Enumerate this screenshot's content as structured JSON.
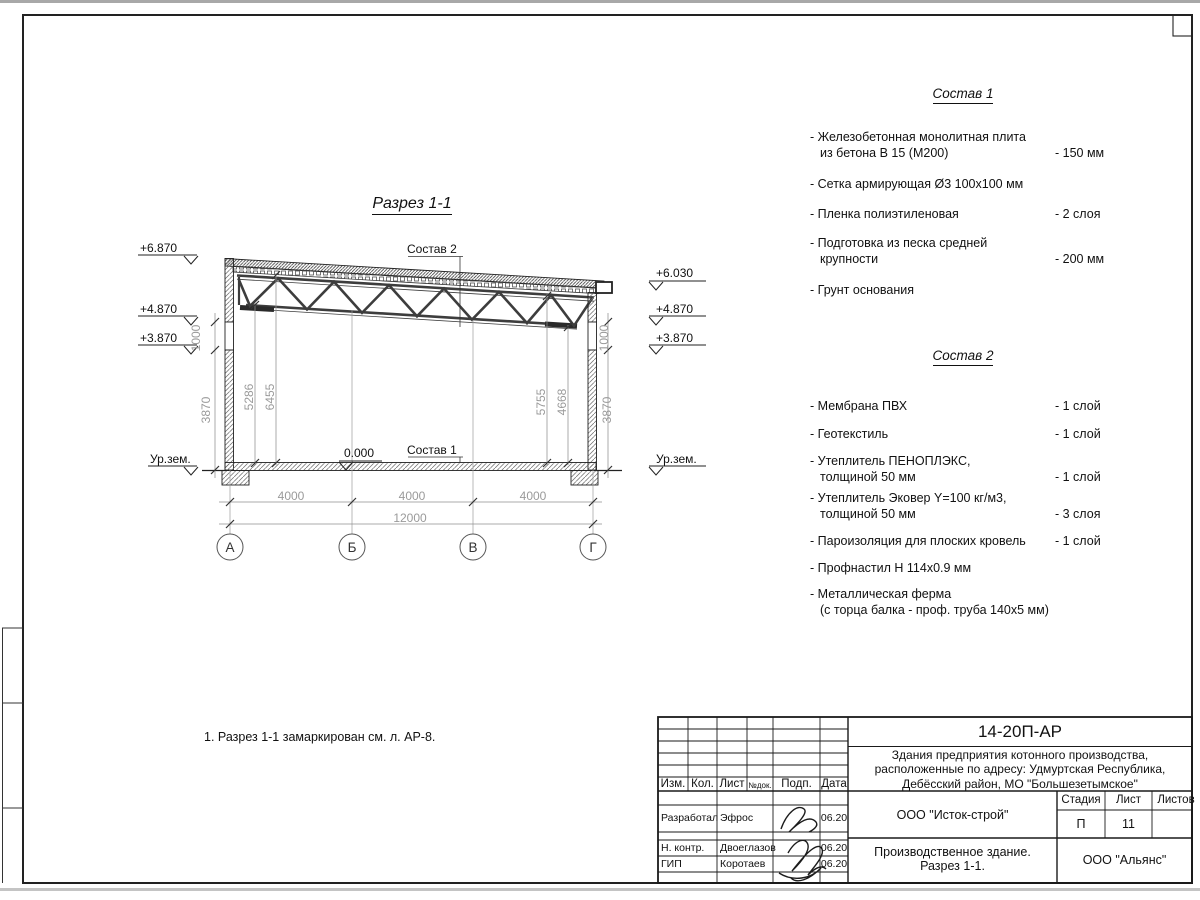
{
  "drawing": {
    "title": "Разрез 1-1",
    "note": "1. Разрез 1-1 замаркирован см. л. АР-8.",
    "labels": {
      "sostav1_ref": "Состав 1",
      "sostav2_ref": "Состав 2",
      "zero": "0.000",
      "ground_left": "Ур.зем.",
      "ground_right": "Ур.зем."
    },
    "elevations_left": [
      "+6.870",
      "+4.870",
      "+3.870"
    ],
    "elevations_right": [
      "+6.030",
      "+4.870",
      "+3.870"
    ],
    "axes": [
      "А",
      "Б",
      "В",
      "Г"
    ],
    "dims": {
      "spans": [
        "4000",
        "4000",
        "4000"
      ],
      "total": "12000",
      "wall_left": [
        "1000",
        "3870"
      ],
      "wall_right": [
        "1000",
        "3870"
      ],
      "interior_left": [
        "5286",
        "6455"
      ],
      "interior_right": [
        "5755",
        "4668"
      ]
    }
  },
  "sostav1": {
    "title": "Состав 1",
    "items": [
      {
        "l1": "- Железобетонная  монолитная плита",
        "l2": "из бетона В 15 (М200)",
        "val": "- 150 мм"
      },
      {
        "l1": "- Сетка армирующая Ø3 100х100 мм",
        "l2": "",
        "val": ""
      },
      {
        "l1": "- Пленка полиэтиленовая",
        "l2": "",
        "val": "-  2 слоя"
      },
      {
        "l1": "- Подготовка из песка средней",
        "l2": "крупности",
        "val": "- 200 мм"
      },
      {
        "l1": "- Грунт основания",
        "l2": "",
        "val": ""
      }
    ]
  },
  "sostav2": {
    "title": "Состав 2",
    "items": [
      {
        "l1": "- Мембрана ПВХ",
        "l2": "",
        "val": "- 1 слой"
      },
      {
        "l1": "- Геотекстиль",
        "l2": "",
        "val": "- 1 слой"
      },
      {
        "l1": "- Утеплитель ПЕНОПЛЭКС,",
        "l2": "толщиной 50 мм",
        "val": "- 1 слой"
      },
      {
        "l1": "- Утеплитель Эковер Y=100 кг/м3,",
        "l2": "толщиной 50 мм",
        "val": "- 3 слоя"
      },
      {
        "l1": "- Пароизоляция для плоских кровель",
        "l2": "",
        "val": "- 1 слой"
      },
      {
        "l1": "- Профнастил Н 114х0.9 мм",
        "l2": "",
        "val": ""
      },
      {
        "l1": "- Металлическая ферма",
        "l2": "(с торца балка - проф. труба 140х5 мм)",
        "val": ""
      }
    ]
  },
  "titleblock": {
    "doc_number": "14-20П-АР",
    "project_name_l1": "Здания предприятия котонного производства,",
    "project_name_l2": "расположенные по адресу: Удмуртская Республика,",
    "project_name_l3": "Дебёсский район, МО \"Большезетымское\"",
    "org1": "ООО \"Исток-строй\"",
    "org2": "ООО \"Альянс\"",
    "sheet_title_l1": "Производственное здание.",
    "sheet_title_l2": "Разрез 1-1.",
    "cols": {
      "izm": "Изм.",
      "kol": "Кол.",
      "list": "Лист",
      "ndok": "№док.",
      "podp": "Подп.",
      "data": "Дата"
    },
    "stage_header": {
      "stadia": "Стадия",
      "list": "Лист",
      "listov": "Листов"
    },
    "stage": "П",
    "sheet_no": "11",
    "rows": [
      {
        "role": "Разработал",
        "name": "Эфрос",
        "date": "06.20"
      },
      {
        "role": "Н. контр.",
        "name": "Двоеглазов",
        "date": "06.20"
      },
      {
        "role": "ГИП",
        "name": "Коротаев",
        "date": "06.20"
      }
    ]
  }
}
